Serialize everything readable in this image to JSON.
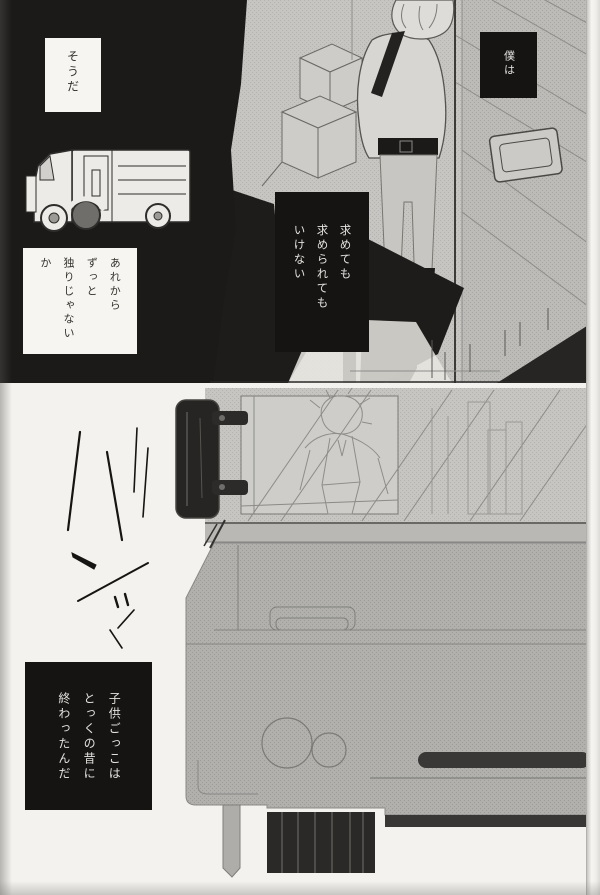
{
  "page": {
    "kind": "manga page scan",
    "colors": {
      "paper": "#f4f2ee",
      "ink_black": "#1b1a19",
      "tone_wall": "#c6c5c2",
      "tone_machine": "#b1b0ad",
      "tone_dark_band": "#393836",
      "caption_black_box": "#151413",
      "caption_white_box": "#f7f5f1"
    }
  },
  "top_panel": {
    "balloon_soda": "そうだ",
    "balloon_arekara": "あれから\nずっと\n独りじゃないか",
    "caption_bokuwa": "僕は",
    "caption_motomete": "求めても\n求められても\nいけない",
    "art": {
      "truck": "truck-line-drawing",
      "crates": "stacked-crates-drawing",
      "character": "character-back-view-drawing",
      "door_slot": "door-slot-plate-drawing",
      "shadows": "black-shadow-shapes"
    }
  },
  "bottom_panel": {
    "caption_kodomo": "子供ごっこは\nとっくの昔に\n終わったんだ",
    "art": {
      "hinge": "door-hinge-drawing",
      "window_figure": "figure-reflected-in-window-drawing",
      "machine": "large-machine-body-drawing",
      "wheel_circles": "machine-circle-details",
      "ink_strokes": "scattered-ink-strokes"
    }
  }
}
